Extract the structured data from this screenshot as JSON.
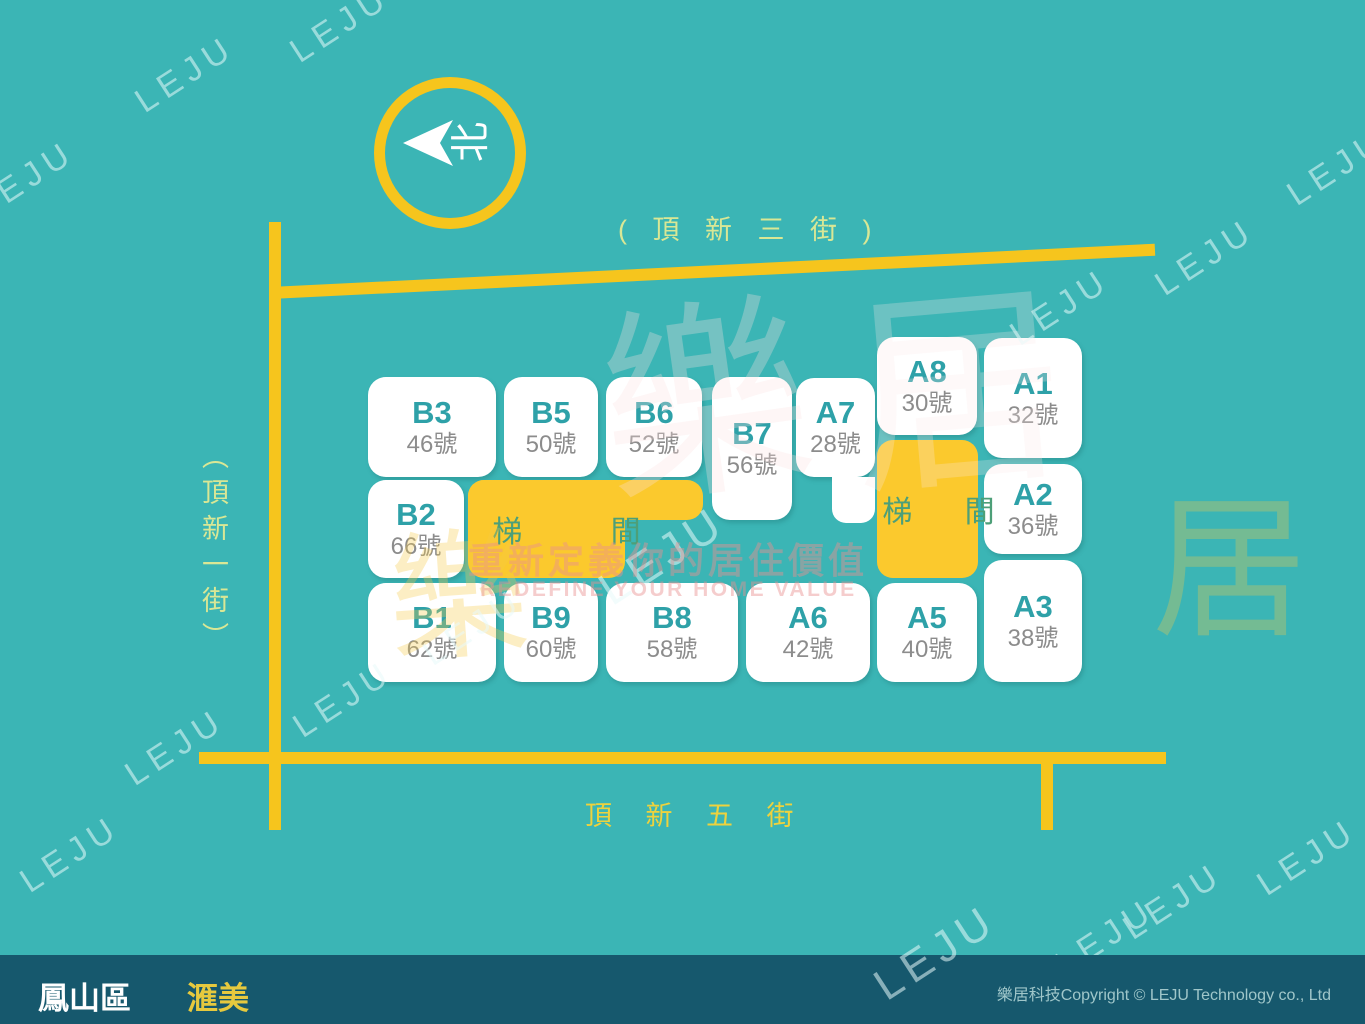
{
  "map": {
    "compass_label": "北",
    "streets": {
      "top": "( 頂 新 三 街 )",
      "left": "（頂新一街）",
      "bottom": "頂 新 五 街"
    },
    "units": [
      {
        "id": "B3",
        "label": "B3",
        "number": "46號",
        "rect": [
          368,
          377,
          128,
          100
        ]
      },
      {
        "id": "B5",
        "label": "B5",
        "number": "50號",
        "rect": [
          504,
          377,
          94,
          100
        ]
      },
      {
        "id": "B6",
        "label": "B6",
        "number": "52號",
        "rect": [
          606,
          377,
          96,
          100
        ]
      },
      {
        "id": "B7",
        "label": "B7",
        "number": "56號",
        "rect": [
          712,
          377,
          80,
          143
        ]
      },
      {
        "id": "A7",
        "label": "A7",
        "number": "28號",
        "rect": [
          796,
          378,
          79,
          99
        ]
      },
      {
        "id": "A8",
        "label": "A8",
        "number": "30號",
        "rect": [
          877,
          337,
          100,
          98
        ]
      },
      {
        "id": "A1",
        "label": "A1",
        "number": "32號",
        "rect": [
          984,
          338,
          98,
          120
        ]
      },
      {
        "id": "B2",
        "label": "B2",
        "number": "66號",
        "rect": [
          368,
          480,
          96,
          98
        ]
      },
      {
        "id": "A2",
        "label": "A2",
        "number": "36號",
        "rect": [
          984,
          464,
          98,
          90
        ]
      },
      {
        "id": "A3",
        "label": "A3",
        "number": "38號",
        "rect": [
          984,
          560,
          98,
          122
        ]
      },
      {
        "id": "B1",
        "label": "B1",
        "number": "62號",
        "rect": [
          368,
          583,
          128,
          99
        ]
      },
      {
        "id": "B9",
        "label": "B9",
        "number": "60號",
        "rect": [
          504,
          583,
          94,
          99
        ]
      },
      {
        "id": "B8",
        "label": "B8",
        "number": "58號",
        "rect": [
          606,
          583,
          132,
          99
        ]
      },
      {
        "id": "A6",
        "label": "A6",
        "number": "42號",
        "rect": [
          746,
          583,
          124,
          99
        ]
      },
      {
        "id": "A5",
        "label": "A5",
        "number": "40號",
        "rect": [
          877,
          583,
          100,
          99
        ]
      }
    ],
    "unit_extensions": [
      [
        832,
        477,
        43,
        46
      ]
    ],
    "stairwells": [
      {
        "label": "梯 間",
        "rects": [
          [
            468,
            480,
            157,
            98
          ],
          [
            468,
            480,
            235,
            40
          ]
        ],
        "label_rect": [
          468,
          480,
          157,
          98
        ],
        "spacing": 40
      },
      {
        "label": "梯 間",
        "rects": [
          [
            877,
            440,
            101,
            138
          ]
        ],
        "label_rect": [
          877,
          440,
          101,
          138
        ],
        "spacing": 22
      }
    ]
  },
  "watermarks": {
    "tile_text": "LEJU",
    "tiles": [
      {
        "x": 285,
        "y": 5
      },
      {
        "x": 130,
        "y": 55
      },
      {
        "x": -30,
        "y": 160
      },
      {
        "x": 1150,
        "y": 238
      },
      {
        "x": 1282,
        "y": 148
      },
      {
        "x": 1005,
        "y": 288
      },
      {
        "x": 592,
        "y": 528,
        "size": 46
      },
      {
        "x": 418,
        "y": 608
      },
      {
        "x": 288,
        "y": 680
      },
      {
        "x": 120,
        "y": 728
      },
      {
        "x": 15,
        "y": 835
      },
      {
        "x": 1252,
        "y": 838
      },
      {
        "x": 1118,
        "y": 882
      },
      {
        "x": 868,
        "y": 928,
        "size": 44,
        "front": true
      },
      {
        "x": 1050,
        "y": 918
      }
    ],
    "script_glyphs": [
      {
        "t": "樂",
        "x": 600,
        "y": 300,
        "size": 210,
        "color": "rgba(252,226,226,0.30)",
        "rot": -8
      },
      {
        "t": "居",
        "x": 850,
        "y": 285,
        "size": 215,
        "color": "rgba(252,230,230,0.26)",
        "rot": -5
      },
      {
        "t": "樂",
        "x": 388,
        "y": 528,
        "size": 140,
        "color": "rgba(247,203,70,0.32)",
        "rot": -4
      },
      {
        "t": "居",
        "x": 1152,
        "y": 492,
        "size": 155,
        "color": "rgba(247,203,70,0.30)",
        "rot": 0
      }
    ],
    "slogan_cjk": "重新定義你的居住價值",
    "slogan_en": "REDEFINE YOUR HOME VALUE"
  },
  "footer": {
    "district": "鳳山區",
    "project": "滙美",
    "copyright": "樂居科技Copyright © LEJU Technology co., Ltd"
  },
  "colors": {
    "background": "#3bb5b5",
    "road": "#f6c51d",
    "stairwell": "#fbc92d",
    "unit_label": "#2ea1a8",
    "unit_number": "#8c8c8c",
    "stair_text": "#4d9f78",
    "street_label": "#d9e795",
    "street_label_bottom": "#eed23d",
    "footer_bg": "#16586d",
    "footer_project": "#e6c93e"
  }
}
